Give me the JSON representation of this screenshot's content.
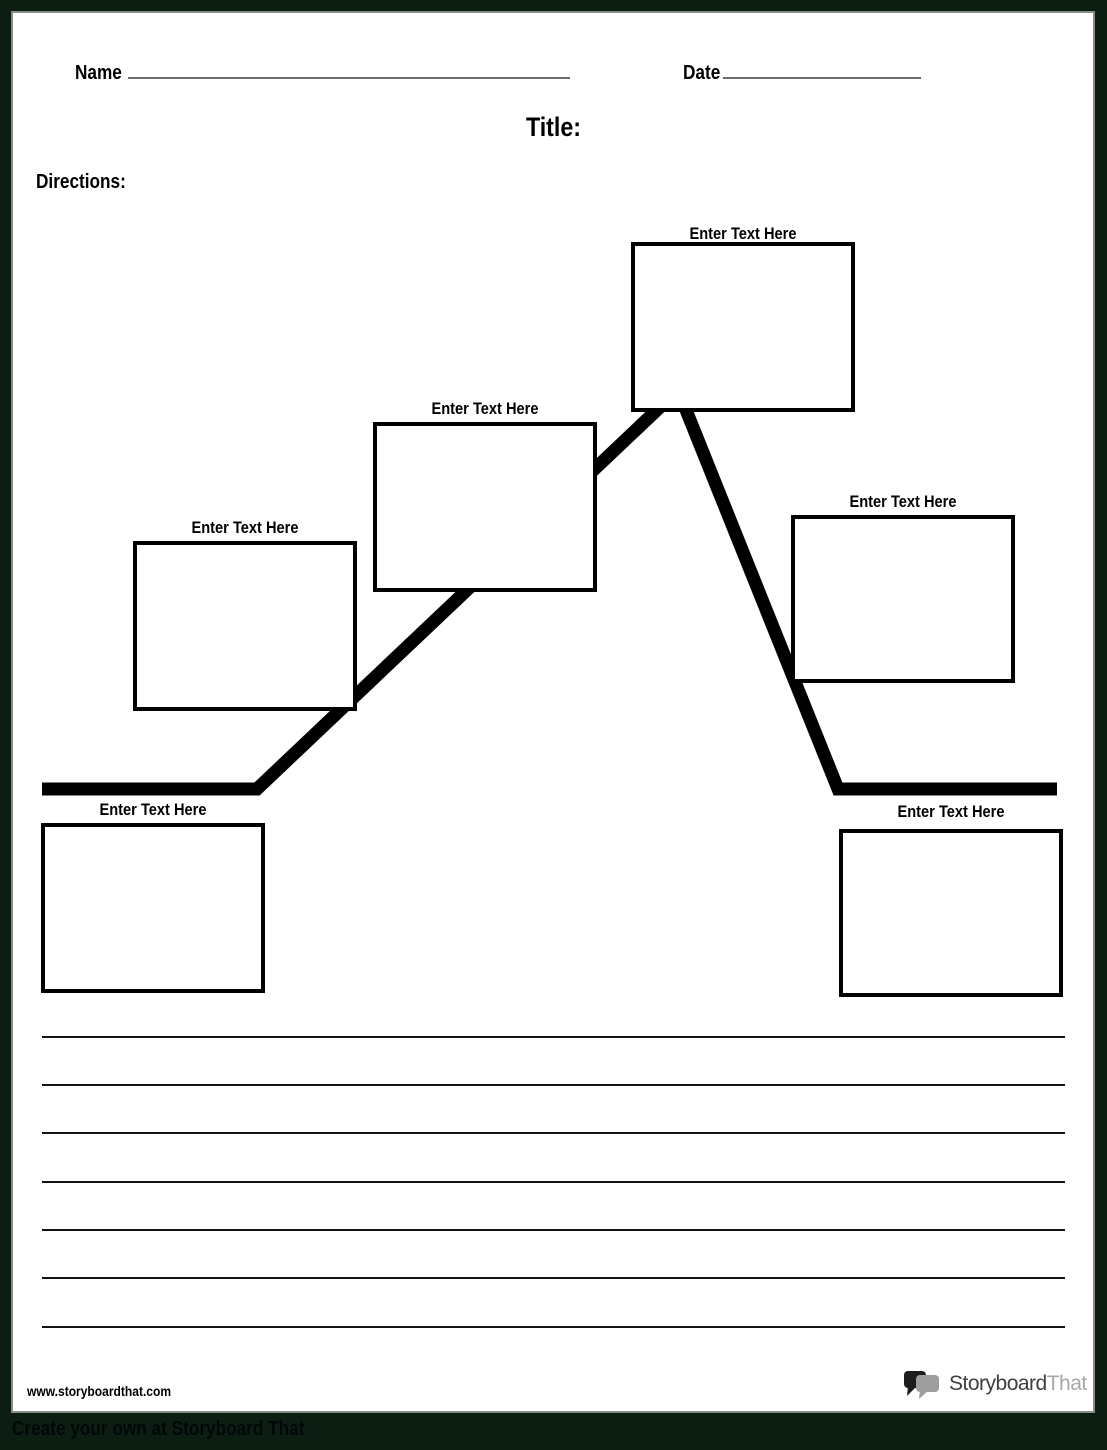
{
  "header": {
    "name_label": "Name",
    "date_label": "Date",
    "title": "Title:",
    "directions_label": "Directions:"
  },
  "diagram": {
    "type": "plot-structure-mountain",
    "boxes": [
      {
        "id": "exposition",
        "label": "Enter Text Here"
      },
      {
        "id": "rising-action-1",
        "label": "Enter Text Here"
      },
      {
        "id": "rising-action-2",
        "label": "Enter Text Here"
      },
      {
        "id": "climax",
        "label": "Enter Text Here"
      },
      {
        "id": "falling-action",
        "label": "Enter Text Here"
      },
      {
        "id": "resolution",
        "label": "Enter Text Here"
      }
    ]
  },
  "writing_area": {
    "line_count": 7
  },
  "footer": {
    "url": "www.storyboardthat.com",
    "logo_part1": "Storyboard",
    "logo_part2": "That",
    "banner": "Create your own at Storyboard That"
  },
  "colors": {
    "page_border": "#0c1e12",
    "plot_line": "#000000",
    "logo_primary": "#3f3f3f",
    "logo_secondary": "#a8a8a8"
  }
}
